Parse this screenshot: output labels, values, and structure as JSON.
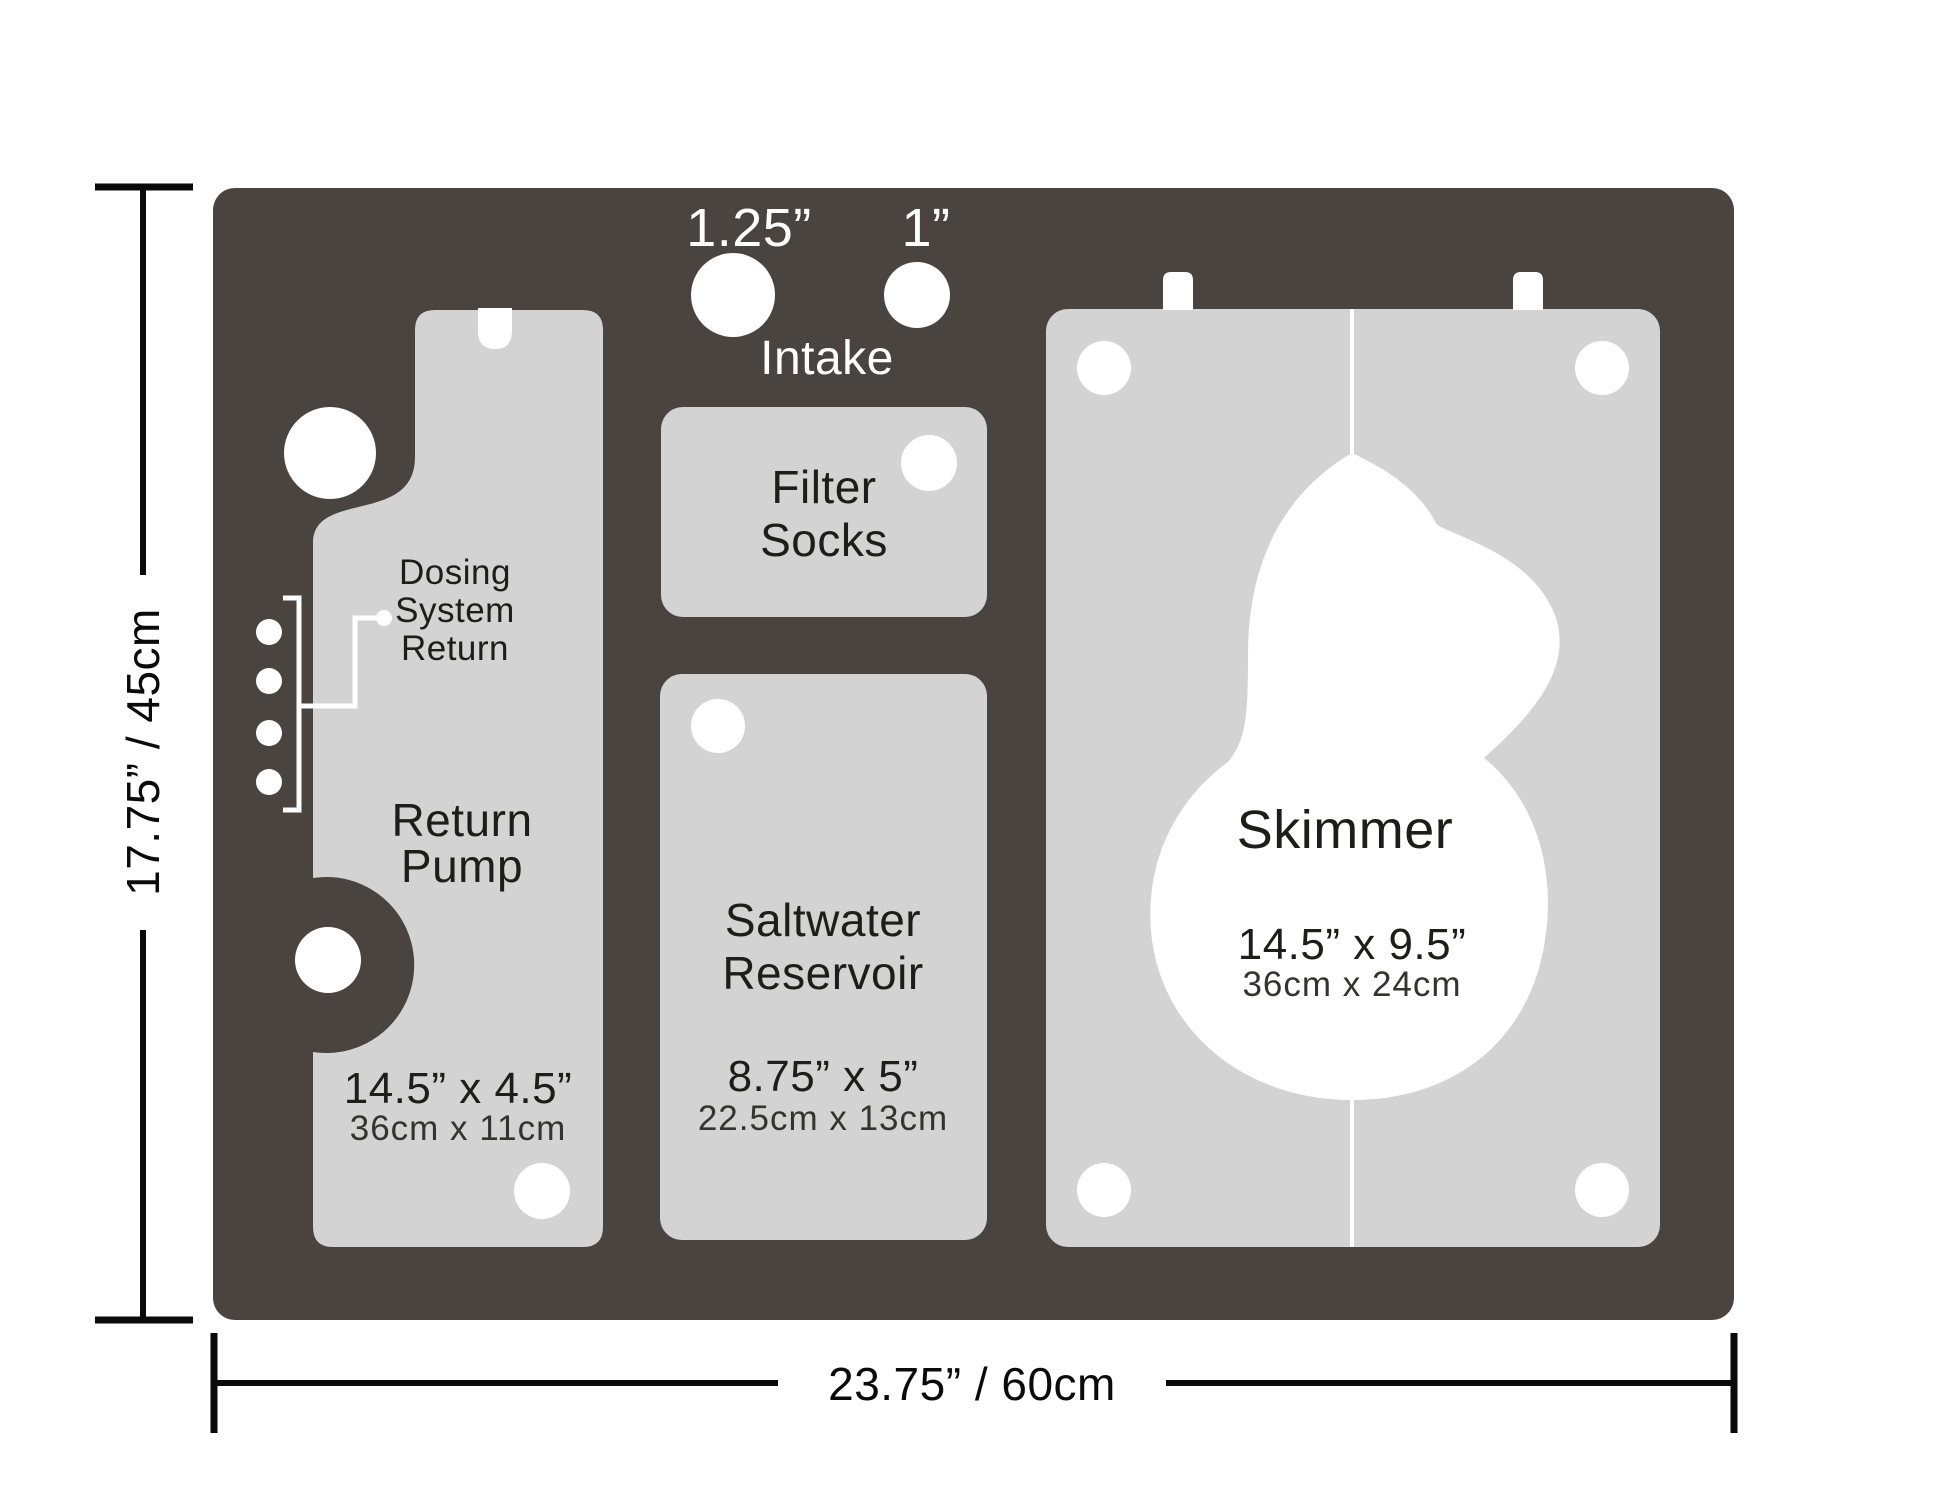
{
  "colors": {
    "panel": "#494440",
    "compartment": "#d3d3d3",
    "hole": "#ffffff",
    "label": "#1d1d1b",
    "sublabel": "#333331",
    "dimension": "#0a0a0a"
  },
  "dimensions": {
    "height_label": "17.75” / 45cm",
    "width_label": "23.75” / 60cm"
  },
  "intake": {
    "large_hole_label": "1.25”",
    "small_hole_label": "1”",
    "caption": "Intake"
  },
  "compartments": {
    "return_pump": {
      "annotation": [
        "Dosing",
        "System",
        "Return"
      ],
      "name": [
        "Return",
        "Pump"
      ],
      "size_in": "14.5” x 4.5”",
      "size_cm": "36cm x 11cm"
    },
    "filter_socks": {
      "name": [
        "Filter",
        "Socks"
      ]
    },
    "saltwater_reservoir": {
      "name": [
        "Saltwater",
        "Reservoir"
      ],
      "size_in": "8.75” x 5”",
      "size_cm": "22.5cm x 13cm"
    },
    "skimmer": {
      "name": "Skimmer",
      "size_in": "14.5” x 9.5”",
      "size_cm": "36cm x  24cm"
    }
  }
}
